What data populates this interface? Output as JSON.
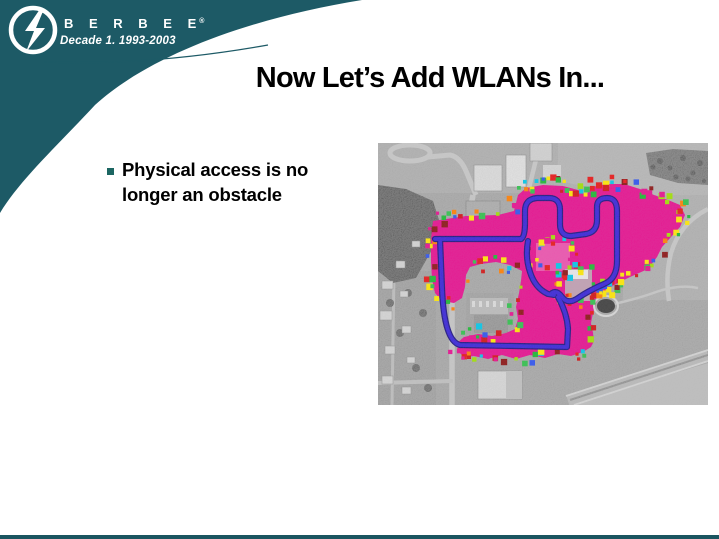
{
  "logo": {
    "brand_letters": "B E R B E E",
    "registered_mark": "®",
    "tagline": "Decade 1.  1993-2003"
  },
  "slide": {
    "title": "Now Let’s Add WLANs In...",
    "bullet": {
      "lines": [
        "Physical access is no",
        "longer an obstacle"
      ]
    }
  },
  "theme": {
    "teal": "#1d5a66",
    "bottom_bar": "#1a5560",
    "bullet_square": "#1c6662",
    "title_color": "#000000"
  },
  "figure": {
    "description": "grayscale aerial photo with magenta WLAN coverage heatmap and blue survey path",
    "colors": {
      "coverage_magenta": "#e60c8e",
      "survey_path_blue": "#3520d8",
      "path_outline": "#1a1080",
      "photo_gray": "#969696"
    },
    "heatmap": {
      "seed": 7,
      "step": 5,
      "palette": [
        "#e81212",
        "#d21010",
        "#ff7d00",
        "#ffe800",
        "#ffe800",
        "#9fe000",
        "#2ec04a",
        "#18b830",
        "#00c6e8",
        "#2a50f0",
        "#e60c8e",
        "#e60c8e",
        "#8a0f0f"
      ],
      "blob": [
        [
          55,
          78
        ],
        [
          88,
          73
        ],
        [
          120,
          72
        ],
        [
          136,
          68
        ],
        [
          140,
          52
        ],
        [
          148,
          45
        ],
        [
          165,
          42
        ],
        [
          185,
          43
        ],
        [
          200,
          47
        ],
        [
          208,
          52
        ],
        [
          214,
          44
        ],
        [
          228,
          41
        ],
        [
          246,
          41
        ],
        [
          262,
          46
        ],
        [
          276,
          52
        ],
        [
          290,
          57
        ],
        [
          302,
          62
        ],
        [
          307,
          72
        ],
        [
          302,
          84
        ],
        [
          293,
          94
        ],
        [
          284,
          104
        ],
        [
          279,
          114
        ],
        [
          270,
          126
        ],
        [
          252,
          134
        ],
        [
          236,
          142
        ],
        [
          224,
          150
        ],
        [
          218,
          160
        ],
        [
          215,
          170
        ],
        [
          213,
          180
        ],
        [
          215,
          190
        ],
        [
          216,
          198
        ],
        [
          213,
          204
        ],
        [
          205,
          209
        ],
        [
          193,
          213
        ],
        [
          180,
          211
        ],
        [
          167,
          215
        ],
        [
          152,
          212
        ],
        [
          138,
          216
        ],
        [
          124,
          212
        ],
        [
          110,
          216
        ],
        [
          96,
          213
        ],
        [
          86,
          214
        ],
        [
          80,
          208
        ],
        [
          79,
          200
        ],
        [
          86,
          194
        ],
        [
          100,
          191
        ],
        [
          114,
          193
        ],
        [
          128,
          190
        ],
        [
          137,
          186
        ],
        [
          140,
          176
        ],
        [
          138,
          164
        ],
        [
          141,
          150
        ],
        [
          143,
          138
        ],
        [
          144,
          128
        ],
        [
          132,
          122
        ],
        [
          118,
          119
        ],
        [
          103,
          121
        ],
        [
          92,
          124
        ],
        [
          88,
          132
        ],
        [
          87,
          144
        ],
        [
          84,
          155
        ],
        [
          76,
          160
        ],
        [
          64,
          158
        ],
        [
          57,
          150
        ],
        [
          54,
          136
        ],
        [
          53,
          118
        ],
        [
          53,
          98
        ],
        [
          54,
          86
        ]
      ],
      "inner_edges": [
        [
          [
            158,
            100
          ],
          [
            192,
            100
          ],
          [
            192,
            128
          ],
          [
            158,
            128
          ],
          [
            158,
            100
          ]
        ],
        [
          [
            186,
            124
          ],
          [
            214,
            124
          ],
          [
            214,
            158
          ],
          [
            186,
            158
          ],
          [
            186,
            124
          ]
        ],
        [
          [
            216,
            148
          ],
          [
            248,
            136
          ]
        ]
      ]
    },
    "path_segments": [
      "M57,96 L143,96",
      "M62,96 L64,145 Q66,198 82,202 L188,204",
      "M143,96 Q147,94 147,80 L147,68 Q147,56 159,55 L171,55 Q182,55 182,67 L182,81 Q182,93 193,93 L208,91",
      "M208,91 Q219,89 219,77 L219,64 Q219,55 229,55 Q239,55 239,68 L239,118 Q239,136 226,141 Q210,148 200,155 Q190,162 184,154 Q179,147 174,150",
      "M150,98 Q147,114 152,129 Q157,145 170,151 L176,152",
      "M180,154 Q189,170 190,186 L189,204"
    ]
  }
}
